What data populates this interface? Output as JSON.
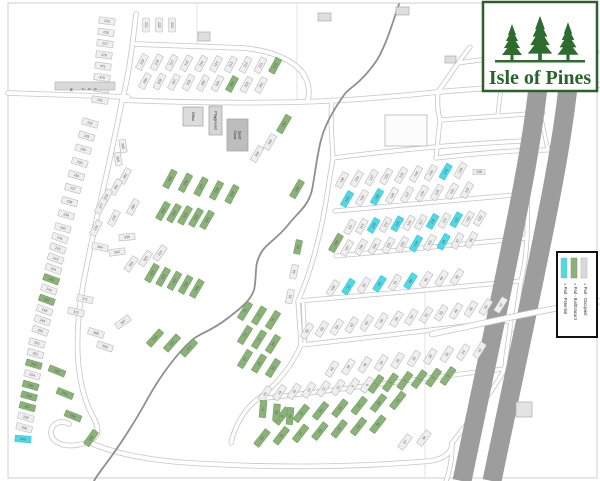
{
  "logo": {
    "title": "Isle of Pines",
    "tree_color": "#2d6b2e",
    "text_color": "#27632a",
    "border_color": "#2d5f2d"
  },
  "legend": {
    "entries": [
      {
        "label": "= Pad - Potential",
        "color": "#4fd9e7"
      },
      {
        "label": "= Pad - Built/Vacant",
        "color": "#8ab279"
      },
      {
        "label": "= Pad - Occupied",
        "color": "#d9d9d9"
      }
    ]
  },
  "map": {
    "road_sign": "W 250",
    "status_colors": {
      "o": {
        "fill": "#efefef",
        "stroke": "#b9b9b9",
        "text": "#5a5a5a"
      },
      "g": {
        "fill": "#8ab279",
        "stroke": "#74a061",
        "text": "#3f5c36"
      },
      "c": {
        "fill": "#4fd9e7",
        "stroke": "#3fc4d4",
        "text": "#1f6f7a"
      }
    },
    "buildings": [
      {
        "label": "Office",
        "x": 183,
        "y": 107,
        "w": 20,
        "h": 19,
        "fill": "#dcdcdc"
      },
      {
        "label": "Playground",
        "x": 209,
        "y": 106,
        "w": 13,
        "h": 29,
        "fill": "#d6d6d6"
      },
      {
        "label": "Sport Court",
        "x": 227,
        "y": 119,
        "w": 21,
        "h": 32,
        "fill": "#bdbdbd"
      }
    ],
    "structures": [
      {
        "x": 198,
        "y": 32,
        "w": 12,
        "h": 9,
        "fill": "#dedede"
      },
      {
        "x": 318,
        "y": 13,
        "w": 13,
        "h": 8,
        "fill": "#dedede"
      },
      {
        "x": 396,
        "y": 7,
        "w": 13,
        "h": 8,
        "fill": "#dedede"
      },
      {
        "x": 445,
        "y": 56,
        "w": 11,
        "h": 7,
        "fill": "#dedede"
      },
      {
        "x": 516,
        "y": 402,
        "w": 16,
        "h": 15,
        "fill": "#e3e3e3"
      },
      {
        "x": 385,
        "y": 115,
        "w": 42,
        "h": 31,
        "fill": "#fcfcfc"
      }
    ],
    "lot_rows": [
      {
        "x": 107,
        "y": 21,
        "dx": -1,
        "dy": 11.3,
        "a": 8,
        "labels": [
          "225",
          "226",
          "227",
          "228",
          "371",
          "379",
          "230",
          "231"
        ]
      },
      {
        "x": 90,
        "y": 123,
        "dx": -3.4,
        "dy": 13.1,
        "a": 16,
        "labels": [
          "232",
          "233",
          "234",
          "235",
          "236",
          "237",
          "238",
          "239",
          "240"
        ]
      },
      {
        "x": 60,
        "y": 238,
        "dx": -2.2,
        "dy": 10.3,
        "a": 20,
        "labels": [
          "241",
          "242",
          "243",
          "244",
          "245",
          "246",
          "247",
          "248",
          "249",
          "250"
        ],
        "green": [
          4,
          6
        ]
      },
      {
        "x": 37,
        "y": 343,
        "dx": -1.6,
        "dy": 10.6,
        "a": 16,
        "labels": [
          "251",
          "252",
          "253",
          "254",
          "255",
          "256",
          "257",
          "258",
          "259"
        ],
        "green": [
          2,
          4,
          5,
          6
        ]
      },
      {
        "x": 23,
        "y": 439,
        "a": 4,
        "labels": [
          "260"
        ],
        "cyan": [
          0
        ]
      },
      {
        "x": 146,
        "y": 25,
        "dx": 13,
        "dy": 0,
        "a": 90,
        "w": 14,
        "labels": [
          "221",
          "222",
          "223"
        ]
      },
      {
        "x": 142,
        "y": 62,
        "dx": 14.8,
        "dy": 0.4,
        "a": -62,
        "labels": [
          "219",
          "218",
          "217",
          "216",
          "215",
          "214",
          "213",
          "212",
          "211",
          "210"
        ],
        "green": [
          9
        ]
      },
      {
        "x": 145,
        "y": 81,
        "dx": 14.5,
        "dy": 0.5,
        "a": -62,
        "labels": [
          "209",
          "208",
          "207",
          "206",
          "205",
          "204",
          "203",
          "202",
          "201"
        ],
        "green": [
          6
        ]
      },
      {
        "x": 270,
        "y": 142,
        "dx": -13,
        "dy": 12,
        "a": -60,
        "labels": [
          "355",
          "356"
        ]
      },
      {
        "x": 284,
        "y": 124,
        "dx": 13,
        "dy": 65,
        "a": -60,
        "w": 19,
        "labels": [
          "360",
          "350"
        ],
        "green": [
          0,
          1
        ]
      },
      {
        "x": 170,
        "y": 179,
        "dx": 15.5,
        "dy": 3.8,
        "a": -62,
        "w": 19,
        "labels": [
          "335",
          "336",
          "337",
          "338",
          "339"
        ],
        "green": [
          0,
          1,
          2,
          3,
          4
        ]
      },
      {
        "x": 163,
        "y": 211,
        "dx": 11,
        "dy": 2.2,
        "a": -60,
        "w": 19,
        "labels": [
          "320",
          "321",
          "322",
          "323",
          "324"
        ],
        "green": [
          0,
          1,
          2,
          3,
          4
        ]
      },
      {
        "x": 152,
        "y": 273,
        "dx": 11.2,
        "dy": 3.9,
        "a": -60,
        "w": 19,
        "labels": [
          "315",
          "316",
          "317",
          "318",
          "319"
        ],
        "green": [
          0,
          1,
          2,
          3,
          4
        ]
      },
      {
        "x": 155,
        "y": 338,
        "dx": 17,
        "dy": 5,
        "a": -48,
        "w": 19,
        "labels": [
          "310",
          "311",
          "313"
        ],
        "green": [
          0,
          1,
          2
        ]
      },
      {
        "x": 125,
        "y": 176,
        "dx": -9,
        "dy": 11,
        "a": -62,
        "labels": [
          "282",
          "281"
        ]
      },
      {
        "x": 106,
        "y": 197,
        "dx": -5,
        "dy": 9,
        "a": -62,
        "labels": [
          "279",
          "277"
        ]
      },
      {
        "x": 133,
        "y": 207,
        "dx": -19,
        "dy": 11,
        "a": -62,
        "labels": [
          "280",
          "278"
        ]
      },
      {
        "x": 96,
        "y": 228,
        "a": -62,
        "labels": [
          "276"
        ]
      },
      {
        "x": 127,
        "y": 237,
        "a": -5,
        "labels": [
          "330"
        ]
      },
      {
        "x": 100,
        "y": 247,
        "a": 12,
        "labels": [
          "304"
        ]
      },
      {
        "x": 117,
        "y": 252,
        "a": -8,
        "labels": [
          "302"
        ]
      },
      {
        "x": 160,
        "y": 253,
        "dx": -14.5,
        "dy": 5.5,
        "a": -55,
        "labels": [
          "314",
          "305",
          "303"
        ]
      },
      {
        "x": 123,
        "y": 146,
        "dx": -5,
        "dy": 13,
        "a": 80,
        "w": 13,
        "labels": [
          "266",
          "265"
        ]
      },
      {
        "x": 85,
        "y": 299,
        "a": 12,
        "labels": [
          "271"
        ]
      },
      {
        "x": 76,
        "y": 312,
        "a": 14,
        "labels": [
          "312"
        ]
      },
      {
        "x": 123,
        "y": 322,
        "a": -35,
        "labels": [
          "307"
        ]
      },
      {
        "x": 96,
        "y": 333,
        "dx": 9,
        "dy": 13.5,
        "a": 18,
        "labels": [
          "308",
          "309"
        ]
      },
      {
        "x": 57,
        "y": 371,
        "dx": 8,
        "dy": 22.5,
        "a": 22,
        "w": 17,
        "labels": [
          "262",
          "263",
          "264"
        ],
        "green": [
          0,
          1,
          2
        ]
      },
      {
        "x": 91,
        "y": 438,
        "a": -55,
        "w": 17,
        "labels": [
          "261"
        ],
        "green": [
          0
        ]
      },
      {
        "x": 342,
        "y": 180,
        "dx": 14.8,
        "dy": -1.2,
        "a": -60,
        "labels": [
          "136",
          "134",
          "137",
          "135",
          "133",
          "146",
          "140",
          "143",
          "139"
        ],
        "cyan": [
          7
        ]
      },
      {
        "x": 479,
        "y": 172,
        "a": 0,
        "w": 12,
        "h": 5.5,
        "labels": [
          "148"
        ]
      },
      {
        "x": 347,
        "y": 199,
        "dx": 15,
        "dy": -1.1,
        "a": -60,
        "labels": [
          "132",
          "130",
          "138",
          "129",
          "127",
          "126",
          "128",
          "131",
          "125"
        ],
        "cyan": [
          0,
          2
        ]
      },
      {
        "x": 350,
        "y": 227,
        "dx": 11.8,
        "dy": -0.8,
        "a": -60,
        "w": 15,
        "labels": [
          "111",
          "113",
          "108",
          "114",
          "118",
          "116",
          "117",
          "119",
          "115",
          "121",
          "122",
          "120"
        ],
        "cyan": [
          2,
          4,
          7,
          9
        ]
      },
      {
        "x": 347,
        "y": 248,
        "dx": 13.8,
        "dy": -0.9,
        "a": -60,
        "labels": [
          "107",
          "106",
          "104",
          "102",
          "100",
          "103",
          "101",
          "98",
          "97",
          "95"
        ],
        "cyan": [
          5,
          7
        ]
      },
      {
        "x": 336,
        "y": 243,
        "a": -60,
        "w": 19,
        "labels": [
          "109"
        ],
        "green": [
          0
        ]
      },
      {
        "x": 333,
        "y": 288,
        "dx": 15.5,
        "dy": -1.4,
        "a": -58,
        "labels": [
          "149",
          "92",
          "90",
          "89",
          "91",
          "88",
          "86",
          "84",
          "82"
        ],
        "cyan": [
          1,
          3,
          5
        ]
      },
      {
        "x": 298,
        "y": 247,
        "dx": -4,
        "dy": 24.7,
        "a": -78,
        "w": 14,
        "labels": [
          "85",
          "83",
          "81"
        ],
        "green": [
          0
        ]
      },
      {
        "x": 307,
        "y": 331,
        "dx": 14.9,
        "dy": -2,
        "a": -58,
        "labels": [
          "68",
          "66",
          "64",
          "62",
          "60",
          "58",
          "56",
          "54",
          "52",
          "50",
          "48",
          "46",
          "44",
          "42"
        ]
      },
      {
        "x": 332,
        "y": 369,
        "dx": 16.4,
        "dy": -2.1,
        "a": -58,
        "labels": [
          "40",
          "38",
          "36",
          "34",
          "32",
          "30",
          "28",
          "26",
          "24",
          "22"
        ]
      },
      {
        "x": 265,
        "y": 394,
        "dx": 14.6,
        "dy": -1.3,
        "a": -55,
        "labels": [
          "20",
          "18",
          "16",
          "14",
          "12",
          "10",
          "8",
          "6"
        ]
      },
      {
        "x": 376,
        "y": 384,
        "dx": 14.4,
        "dy": -1.6,
        "a": -55,
        "w": 19,
        "labels": [
          "7",
          "5",
          "3",
          "1",
          "2",
          "4"
        ],
        "green": [
          0,
          1,
          2,
          3,
          4,
          5
        ]
      },
      {
        "x": 282,
        "y": 416,
        "dx": 19.3,
        "dy": -2.6,
        "a": -52,
        "w": 19,
        "labels": [
          "9",
          "11",
          "13",
          "15",
          "17",
          "19",
          "21"
        ],
        "green": [
          0,
          1,
          2,
          3,
          4,
          5,
          6
        ]
      },
      {
        "x": 262,
        "y": 438,
        "dx": 19.3,
        "dy": -2.3,
        "a": -52,
        "w": 19,
        "labels": [
          "23",
          "25",
          "27",
          "29",
          "31",
          "33",
          "35"
        ],
        "green": [
          0,
          1,
          2,
          3,
          4,
          5,
          6
        ]
      },
      {
        "x": 405,
        "y": 442,
        "dx": 19,
        "dy": -4,
        "a": -52,
        "labels": [
          "37",
          "39"
        ]
      },
      {
        "x": 245,
        "y": 311,
        "dx": 14,
        "dy": 4.5,
        "a": -58,
        "w": 19,
        "labels": [
          "79",
          "77",
          "75"
        ],
        "green": [
          0,
          1,
          2
        ]
      },
      {
        "x": 245,
        "y": 335,
        "dx": 14,
        "dy": 4.5,
        "a": -58,
        "w": 19,
        "labels": [
          "73",
          "71",
          "69"
        ],
        "green": [
          0,
          1,
          2
        ]
      },
      {
        "x": 245,
        "y": 359,
        "dx": 14,
        "dy": 4.5,
        "a": -58,
        "w": 19,
        "labels": [
          "67",
          "65",
          "63"
        ],
        "green": [
          0,
          1,
          2
        ]
      },
      {
        "x": 263,
        "y": 409,
        "dx": 13.5,
        "dy": 3.5,
        "a": -85,
        "w": 17,
        "labels": [
          "57",
          "59",
          "61"
        ],
        "green": [
          0,
          1,
          2
        ]
      }
    ]
  }
}
